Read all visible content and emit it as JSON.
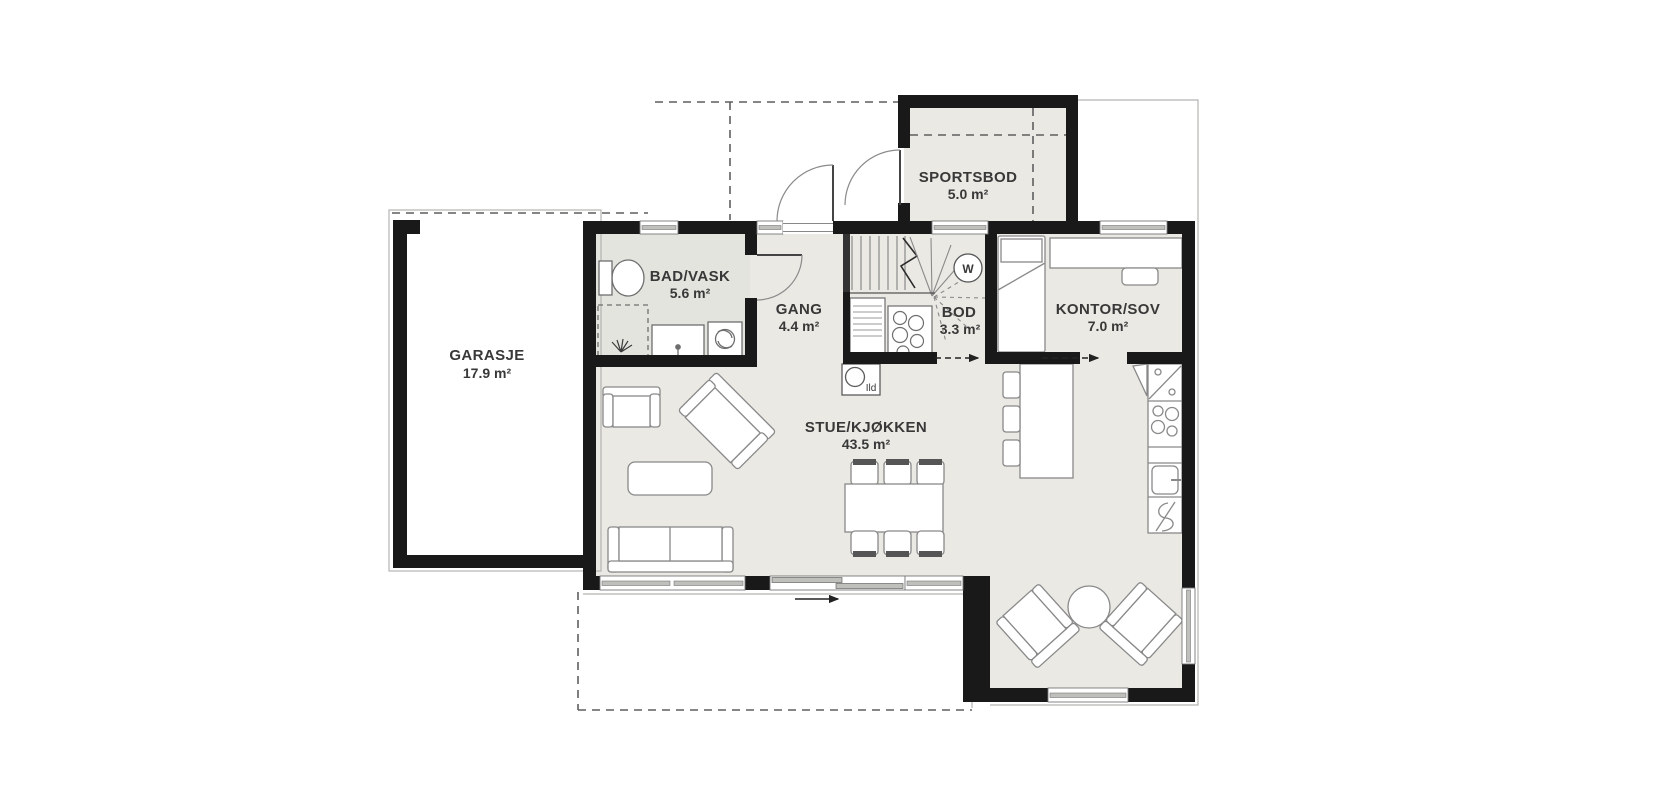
{
  "plan_title": "First floor plan",
  "rooms": [
    {
      "id": "garasje",
      "name": "GARASJE",
      "area": "17.9 m²"
    },
    {
      "id": "sportsbod",
      "name": "SPORTSBOD",
      "area": "5.0 m²"
    },
    {
      "id": "bad-vask",
      "name": "BAD/VASK",
      "area": "5.6 m²"
    },
    {
      "id": "gang",
      "name": "GANG",
      "area": "4.4 m²"
    },
    {
      "id": "bod",
      "name": "BOD",
      "area": "3.3 m²"
    },
    {
      "id": "kontor-sov",
      "name": "KONTOR/SOV",
      "area": "7.0 m²"
    },
    {
      "id": "stue-kjokken",
      "name": "STUE/KJØKKEN",
      "area": "43.5 m²"
    }
  ],
  "annotations": {
    "fireplace_label": "Ild",
    "water_heater_label": "W"
  },
  "colors": {
    "wall": "#191919",
    "floor": "#eae9e4",
    "floor_bath": "#e4e4df",
    "furniture_line": "#898989",
    "window_band": "#bfbfbb",
    "dashed_line": "#5f5f5f",
    "text": "#383838",
    "background": "#ffffff"
  }
}
